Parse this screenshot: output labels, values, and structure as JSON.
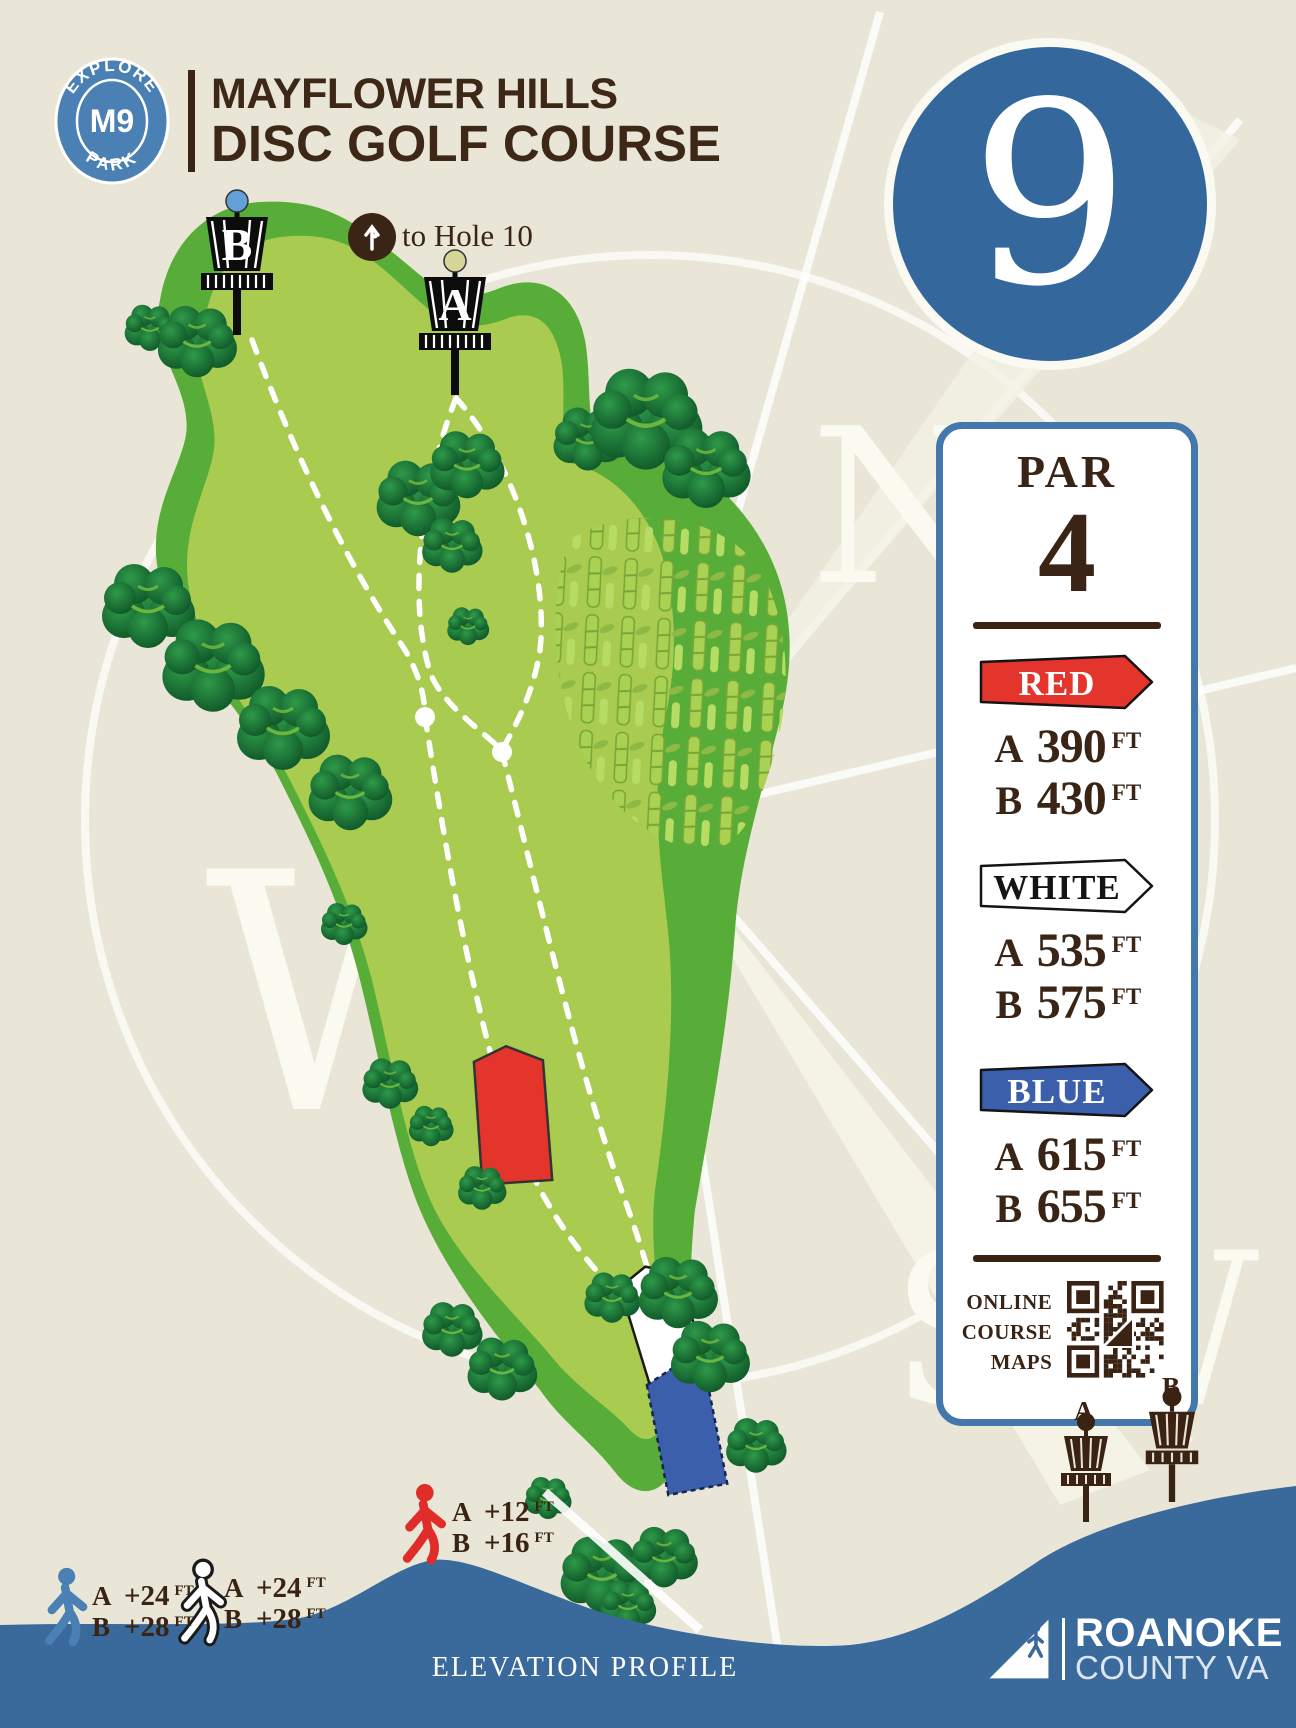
{
  "header": {
    "park_badge": {
      "arc_top": "EXPLORE",
      "center": "M9",
      "arc_bottom": "PARK"
    },
    "title_line1": "MAYFLOWER HILLS",
    "title_line2": "DISC GOLF COURSE"
  },
  "hole_number": "9",
  "info_panel": {
    "par_label": "PAR",
    "par_value": "4",
    "tees": [
      {
        "name": "RED",
        "rows": [
          {
            "letter": "A",
            "value": "390",
            "unit": "FT"
          },
          {
            "letter": "B",
            "value": "430",
            "unit": "FT"
          }
        ]
      },
      {
        "name": "WHITE",
        "rows": [
          {
            "letter": "A",
            "value": "535",
            "unit": "FT"
          },
          {
            "letter": "B",
            "value": "575",
            "unit": "FT"
          }
        ]
      },
      {
        "name": "BLUE",
        "rows": [
          {
            "letter": "A",
            "value": "615",
            "unit": "FT"
          },
          {
            "letter": "B",
            "value": "655",
            "unit": "FT"
          }
        ]
      }
    ],
    "qr_label": [
      "ONLINE",
      "COURSE",
      "MAPS"
    ]
  },
  "map": {
    "to_hole_label": "to Hole 10",
    "baskets": [
      {
        "letter": "B"
      },
      {
        "letter": "A"
      }
    ]
  },
  "compass": {
    "n": "N",
    "w": "W",
    "sw": "SW"
  },
  "elevation": {
    "title": "ELEVATION PROFILE",
    "walkers": [
      {
        "tee": "blue",
        "rows": [
          {
            "letter": "A",
            "value": "+24",
            "unit": "FT"
          },
          {
            "letter": "B",
            "value": "+28",
            "unit": "FT"
          }
        ]
      },
      {
        "tee": "white",
        "rows": [
          {
            "letter": "A",
            "value": "+24",
            "unit": "FT"
          },
          {
            "letter": "B",
            "value": "+28",
            "unit": "FT"
          }
        ]
      },
      {
        "tee": "red",
        "rows": [
          {
            "letter": "A",
            "value": "+12",
            "unit": "FT"
          },
          {
            "letter": "B",
            "value": "+16",
            "unit": "FT"
          }
        ]
      }
    ],
    "baskets": [
      {
        "letter": "A"
      },
      {
        "letter": "B"
      }
    ]
  },
  "footer": {
    "brand_line1": "ROANOKE",
    "brand_line2": "COUNTY VA"
  },
  "colors": {
    "red_tee": "#e3352b",
    "white_tee": "#ffffff",
    "blue_tee": "#3c5fac",
    "panel_border": "#4478ad",
    "hole_circle": "#34689c",
    "elevation_profile": "#3a699c",
    "fairway_light": "#a8cb50",
    "fairway_dark": "#57ad38"
  }
}
